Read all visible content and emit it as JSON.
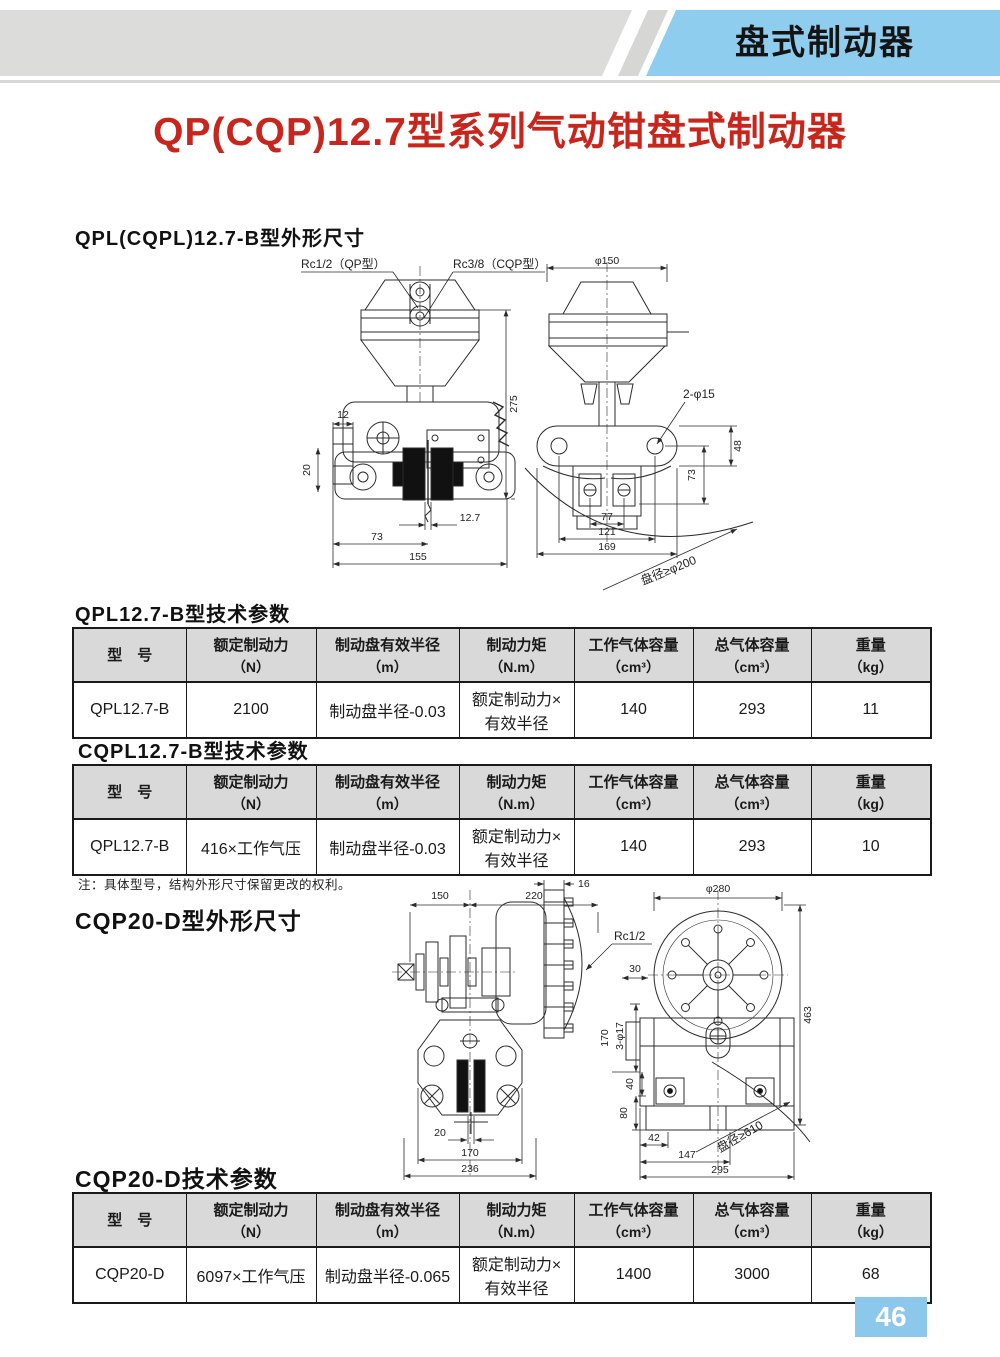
{
  "header": {
    "tab_label": "盘式制动器"
  },
  "title": "QP(CQP)12.7型系列气动钳盘式制动器",
  "page_number": "46",
  "note": "注：具体型号，结构外形尺寸保留更改的权利。",
  "table_columns": [
    {
      "label": "型　号",
      "unit": ""
    },
    {
      "label": "额定制动力",
      "unit": "（N）"
    },
    {
      "label": "制动盘有效半径",
      "unit": "（m）"
    },
    {
      "label": "制动力矩",
      "unit": "（N.m）"
    },
    {
      "label": "工作气体容量",
      "unit": "（cm³）"
    },
    {
      "label": "总气体容量",
      "unit": "（cm³）"
    },
    {
      "label": "重量",
      "unit": "（kg）"
    }
  ],
  "tables": {
    "t1": {
      "heading": "QPL12.7-B型技术参数",
      "row": [
        "QPL12.7-B",
        "2100",
        "制动盘半径-0.03",
        "额定制动力×\n有效半径",
        "140",
        "293",
        "11"
      ]
    },
    "t2": {
      "heading": "CQPL12.7-B型技术参数",
      "row": [
        "QPL12.7-B",
        "416×工作气压",
        "制动盘半径-0.03",
        "额定制动力×\n有效半径",
        "140",
        "293",
        "10"
      ]
    },
    "t3": {
      "heading": "CQP20-D技术参数",
      "row": [
        "CQP20-D",
        "6097×工作气压",
        "制动盘半径-0.065",
        "额定制动力×\n有效半径",
        "1400",
        "3000",
        "68"
      ]
    }
  },
  "drawing1": {
    "heading": "QPL(CQPL)12.7-B型外形尺寸",
    "labels": {
      "port_qp": "Rc1/2（QP型）",
      "port_cqp": "Rc3/8（CQP型）",
      "h275": "275",
      "d12": "12",
      "d20": "20",
      "d73": "73",
      "d12_7": "12.7",
      "d155": "155",
      "phi150": "φ150",
      "holes": "2-φ15",
      "d48": "48",
      "d73r": "73",
      "d77": "77",
      "d121": "121",
      "d169": "169",
      "disc": "盘径≥φ200"
    }
  },
  "drawing2": {
    "heading": "CQP20-D型外形尺寸",
    "labels": {
      "d150": "150",
      "d220": "220",
      "d16": "16",
      "port": "Rc1/2",
      "d20": "20",
      "d170": "170",
      "d236": "236",
      "phi280": "φ280",
      "d30": "30",
      "holes": "3-φ17",
      "d170r": "170",
      "d40": "40",
      "d80": "80",
      "d463": "463",
      "d42": "42",
      "d147": "147",
      "d295": "295",
      "disc": "盘径≥610"
    }
  },
  "colors": {
    "accent_blue": "#8FCDEF",
    "bar_gray": "#DCDCDA",
    "title_red": "#C8251D",
    "table_header_bg": "#D9D9D9",
    "page_badge_blue": "#8CC7EC"
  }
}
